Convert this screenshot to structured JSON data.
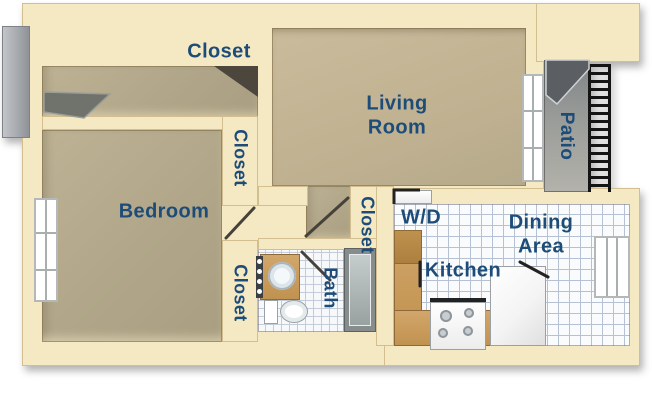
{
  "labels": {
    "closet_top": "Closet",
    "closet_upper": "Closet",
    "closet_lower": "Closet",
    "closet_hall": "Closet",
    "living_1": "Living",
    "living_2": "Room",
    "patio": "Patio",
    "bedroom": "Bedroom",
    "bath": "Bath",
    "wd": "W/D",
    "kitchen": "Kitchen",
    "dining_1": "Dining",
    "dining_2": "Area"
  },
  "colors": {
    "wall": "#F5E9C3",
    "wall_edge": "#C9B27E",
    "floor_tan": "#B1A689",
    "living_floor": "#C0B191",
    "tile_white": "#FAFBFD",
    "tile_grid": "#B6C1D3",
    "patio_gray": "#96999A",
    "label_blue": "#1D4C78",
    "wood": "#C79A5E",
    "railing_black": "#141414"
  }
}
